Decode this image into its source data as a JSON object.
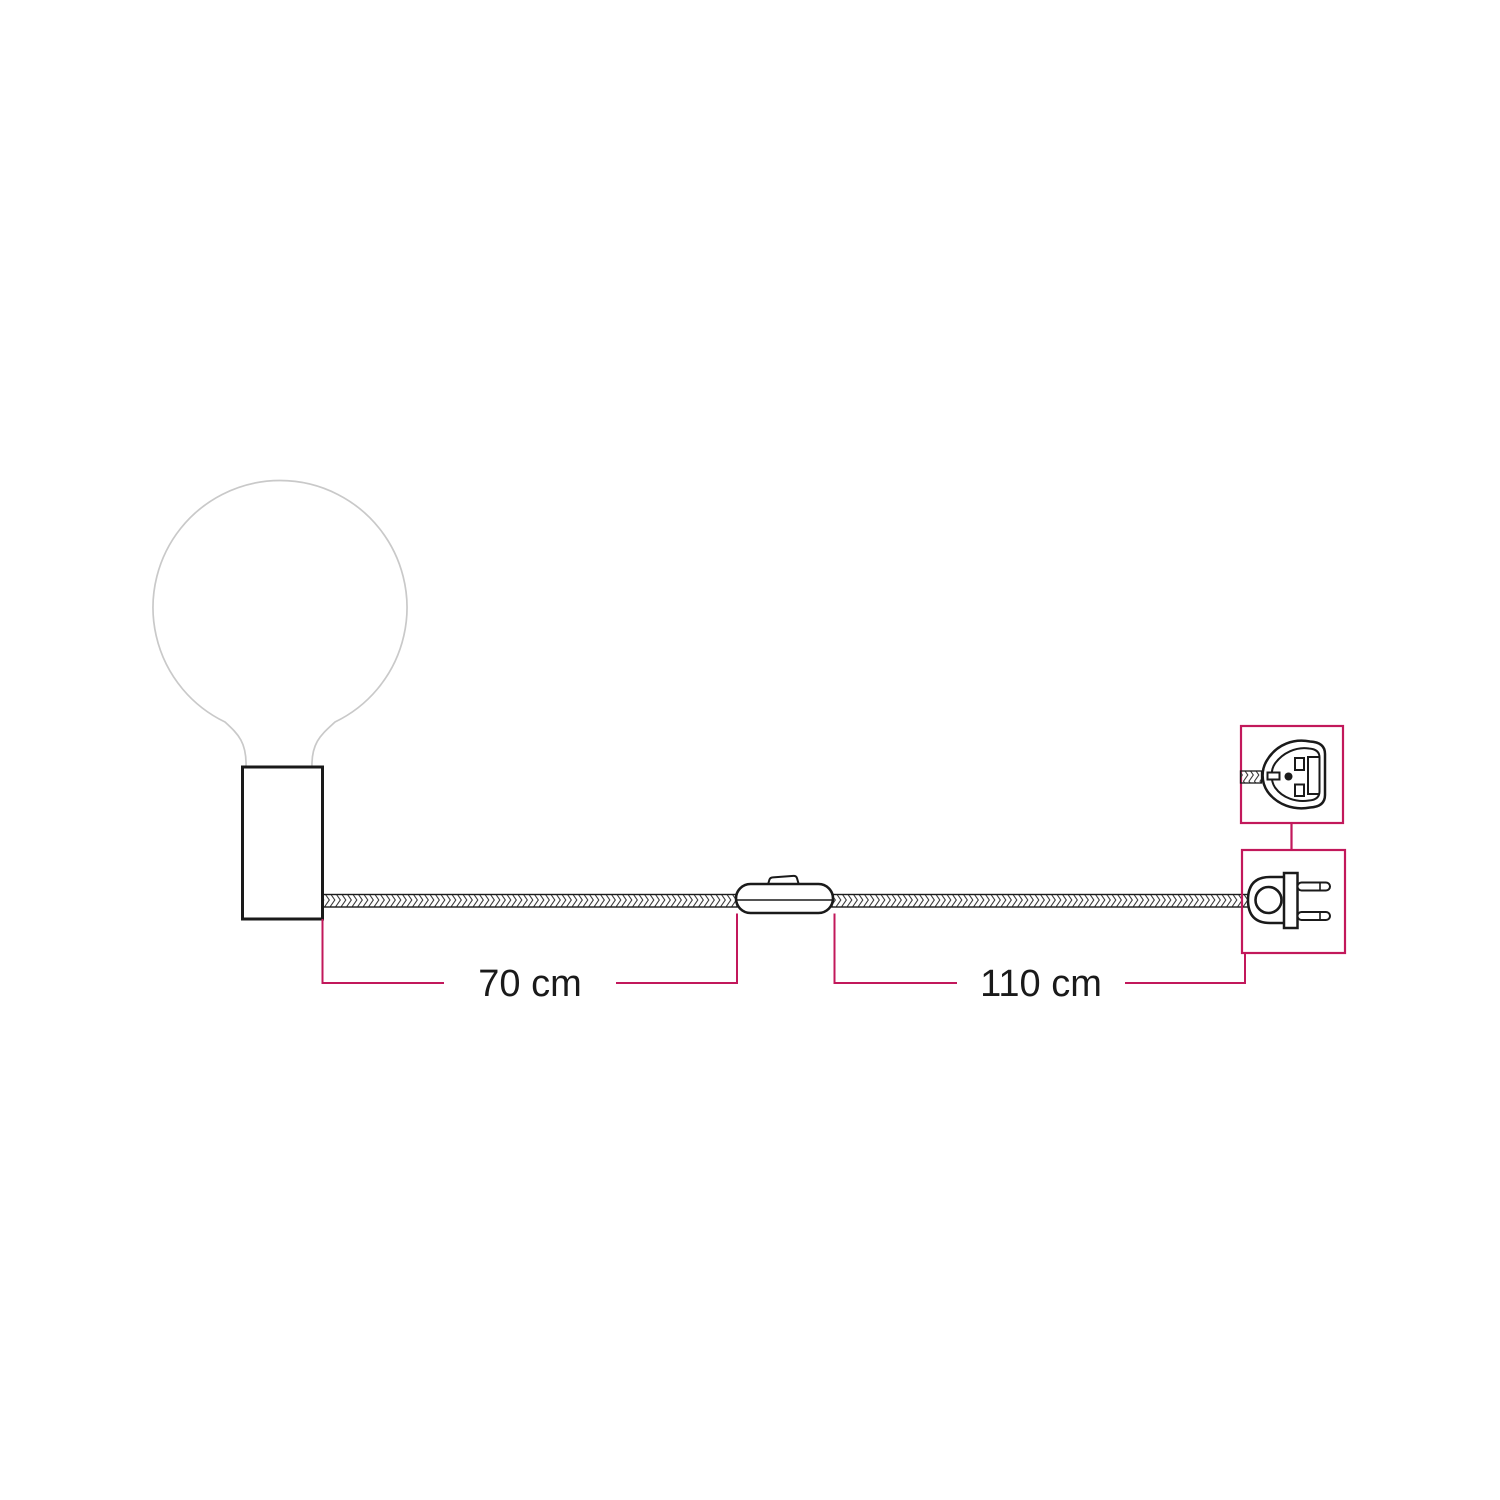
{
  "page": {
    "title": "Lamp with braided cable, inline switch and two-pin plug - dimensions diagram",
    "background": "#ffffff"
  },
  "colors": {
    "line_black": "#1a1a1a",
    "cable_weave": "#3c3c3c",
    "bulb_gray": "#c9c9c9",
    "accent_magenta": "#c2185b",
    "text_color": "#1a1a1a"
  },
  "measurements": [
    {
      "id": "holder-to-switch",
      "label": "70 cm"
    },
    {
      "id": "switch-to-plug",
      "label": "110 cm"
    }
  ],
  "icons": [
    {
      "name": "globe-bulb-icon"
    },
    {
      "name": "lamp-holder-icon"
    },
    {
      "name": "braided-cable-icon"
    },
    {
      "name": "inline-switch-icon"
    },
    {
      "name": "plug-front-icon"
    },
    {
      "name": "plug-side-icon"
    }
  ]
}
